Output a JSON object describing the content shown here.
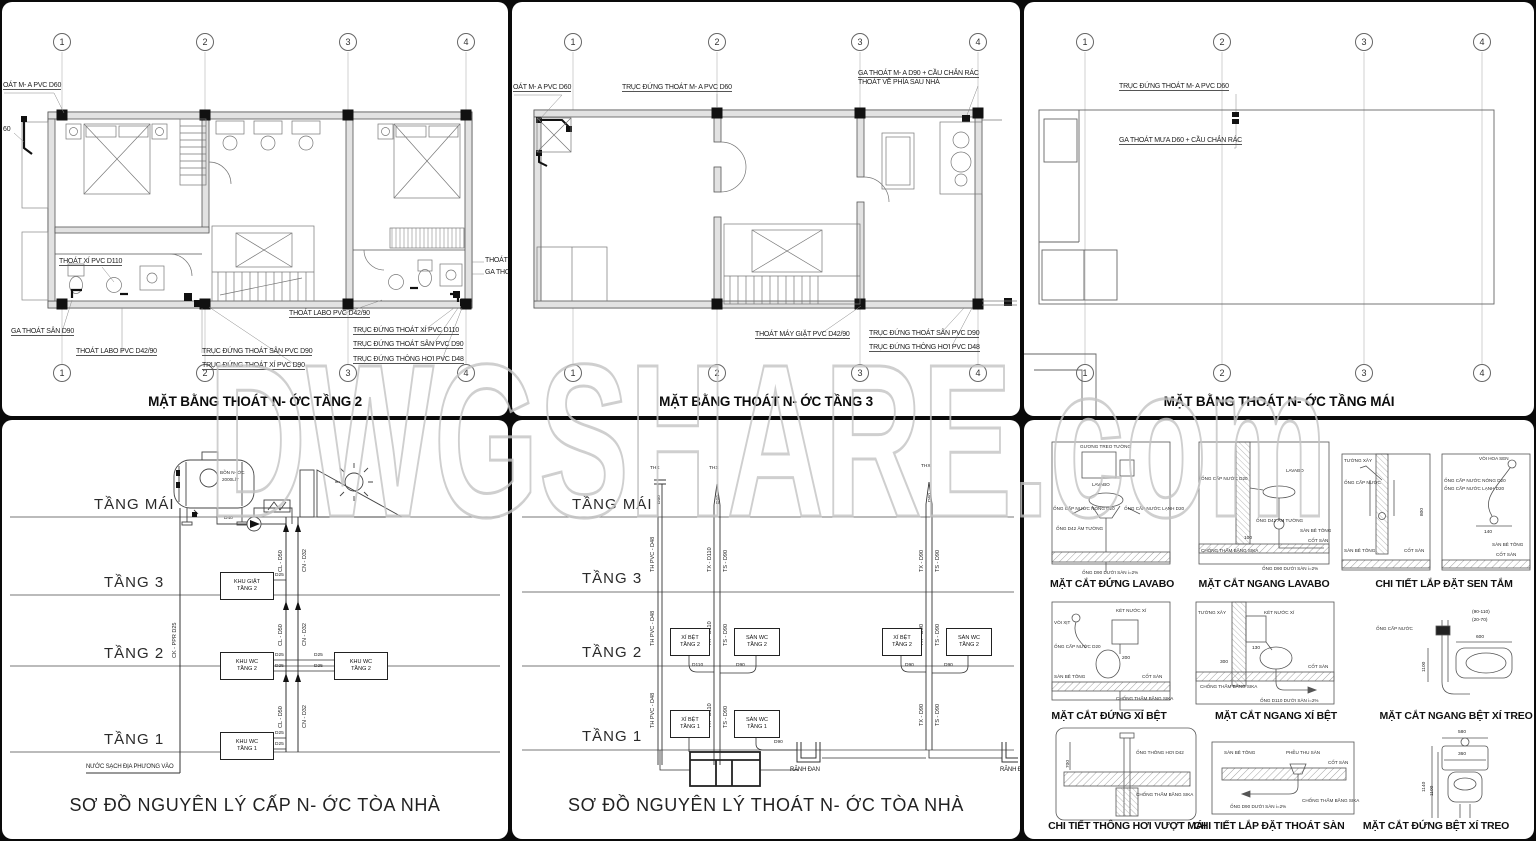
{
  "watermark": {
    "main": "DWGSHARE",
    "suffix": ".com"
  },
  "grid_cols": [
    "1",
    "2",
    "3",
    "4"
  ],
  "floors": [
    "TẦNG MÁI",
    "TẦNG 3",
    "TẦNG 2",
    "TẦNG 1"
  ],
  "p1": {
    "title": "MẶT BẰNG THOÁT N- ỚC TẦNG 2",
    "labels": [
      "OÁT M- A PVC D60",
      "60",
      "THOÁT XÍ PVC D110",
      "GA THOÁT SÂN D90",
      "THOÁT LABO PVC D42/90",
      "TRỤC ĐỨNG THOÁT SÂN PVC D90",
      "TRỤC ĐỨNG THOÁT XÍ PVC D90",
      "THOÁT LABO PVC D42/90",
      "TRỤC ĐỨNG THOÁT XÍ PVC D110",
      "TRỤC ĐỨNG THOÁT SÂN PVC D90",
      "TRỤC ĐỨNG THÔNG HƠI PVC D48",
      "THOÁT X",
      "GA THO"
    ]
  },
  "p2": {
    "title": "MẶT BẰNG THOÁT N- ỚC TẦNG 3",
    "labels": [
      "OÁT M- A PVC D60",
      "TRỤC ĐỨNG THOÁT M- A PVC D60",
      "GA THOÁT M- A D90 + CẦU CHẮN RÁC",
      "THOÁT VỀ PHÍA SAU NHÀ",
      "THOÁT MÁY GIẶT PVC D42/90",
      "TRỤC ĐỨNG THOÁT SÂN PVC D90",
      "TRỤC ĐỨNG THÔNG HƠI PVC D48"
    ]
  },
  "p3": {
    "title": "MẶT BẰNG THOÁT N- ỚC TẦNG MÁI",
    "labels": [
      "TRỤC ĐỨNG THOÁT M- A PVC D60",
      "GA THOÁT MƯA D60 + CẦU CHẮN RÁC"
    ]
  },
  "p4": {
    "title": "SƠ ĐỒ NGUYÊN LÝ CẤP N- ỚC TÒA NHÀ",
    "tank_line1": "BỒN N- ỚC",
    "tank_line2": "2000LÍT",
    "d40": "D40",
    "riser_cl": "CL - D50",
    "riser_cn": "CN - D32",
    "riser_ck": "CK - PPR D25",
    "boxes": [
      "KHU GIẶT\nTẦNG 2",
      "KHU WC\nTẦNG 2",
      "KHU WC\nTẦNG 2",
      "KHU WC\nTẦNG 1"
    ],
    "d25": "D25",
    "note": "NƯỚC SẠCH ĐỊA PHƯƠNG VÀO"
  },
  "p5": {
    "title": "SƠ ĐỒ NGUYÊN LÝ THOÁT N- ỚC TÒA NHÀ",
    "vent": "THX",
    "vent_d": "D60",
    "riser_th": "TH PVC - D48",
    "riser_tx110": "TX - D110",
    "riser_ts90": "TS - D90",
    "riser_tx90": "TX - D90",
    "boxes": [
      "XÍ BỆT\nTẦNG 2",
      "SÀN WC\nTẦNG 2",
      "XÍ BỆT\nTẦNG 2",
      "SÀN WC\nTẦNG 2",
      "XÍ BỆT\nTẦNG 1",
      "SÀN WC\nTẦNG 1"
    ],
    "d110": "D110",
    "d90": "D90",
    "gutter": "RÃNH ĐAN"
  },
  "p6": {
    "titles": [
      "MẶT CẮT ĐỨNG LAVABO",
      "MẶT CẮT NGANG LAVABO",
      "CHI TIẾT LẮP ĐẶT SEN TẮM",
      "MẶT CẮT ĐỨNG XÍ BỆT",
      "MẶT CẮT NGANG XÍ BỆT",
      "MẶT CẮT NGANG BỆT XÍ TREO",
      "CHI TIẾT THÔNG HƠI VƯỢT MÁI",
      "CHI TIẾT LẮP ĐẶT THOÁT SÀN",
      "MẶT CẮT ĐỨNG BỆT XÍ TREO"
    ],
    "ann": {
      "guong": "GƯƠNG TREO TƯỜNG",
      "lavabo": "LAVABO",
      "nong": "ỐNG CẤP NƯỚC NÓNG D20",
      "lanh": "ỐNG CẤP NƯỚC LẠNH D20",
      "am": "ỐNG D42 ÂM TƯỜNG",
      "capd20": "ỐNG CẤP NƯỚC D20",
      "ket": "KÉT NƯỚC XÍ",
      "voixit": "VÒI XỊT",
      "tuong": "TƯỜNG XÂY",
      "sanbt": "SÀN BÊ TÔNG",
      "cotsan": "CỐT SÀN",
      "sika": "CHỐNG THẤM BẰNG SIKA",
      "voisen": "VÒI HOA SEN",
      "capnuoc": "ỐNG CẤP NƯỚC",
      "thonghoi": "ỐNG THÔNG HƠI D42",
      "pheu": "PHỄU THU SÀN",
      "d110san": "ỐNG D110 DƯỚI SÀN i=2%",
      "d90san": "ỐNG D90 DƯỚI SÀN i=2%"
    },
    "dims": [
      "(90-110)",
      "(20-70)",
      "140",
      "800",
      "100",
      "130",
      "300",
      "200",
      "600",
      "1100",
      "580",
      "360",
      "1140",
      "700"
    ]
  },
  "colors": {
    "line": "#4a4a4a",
    "panel": "#ffffff",
    "background": "#0a0a0a",
    "watermark_outline": "#c4c4c4"
  }
}
